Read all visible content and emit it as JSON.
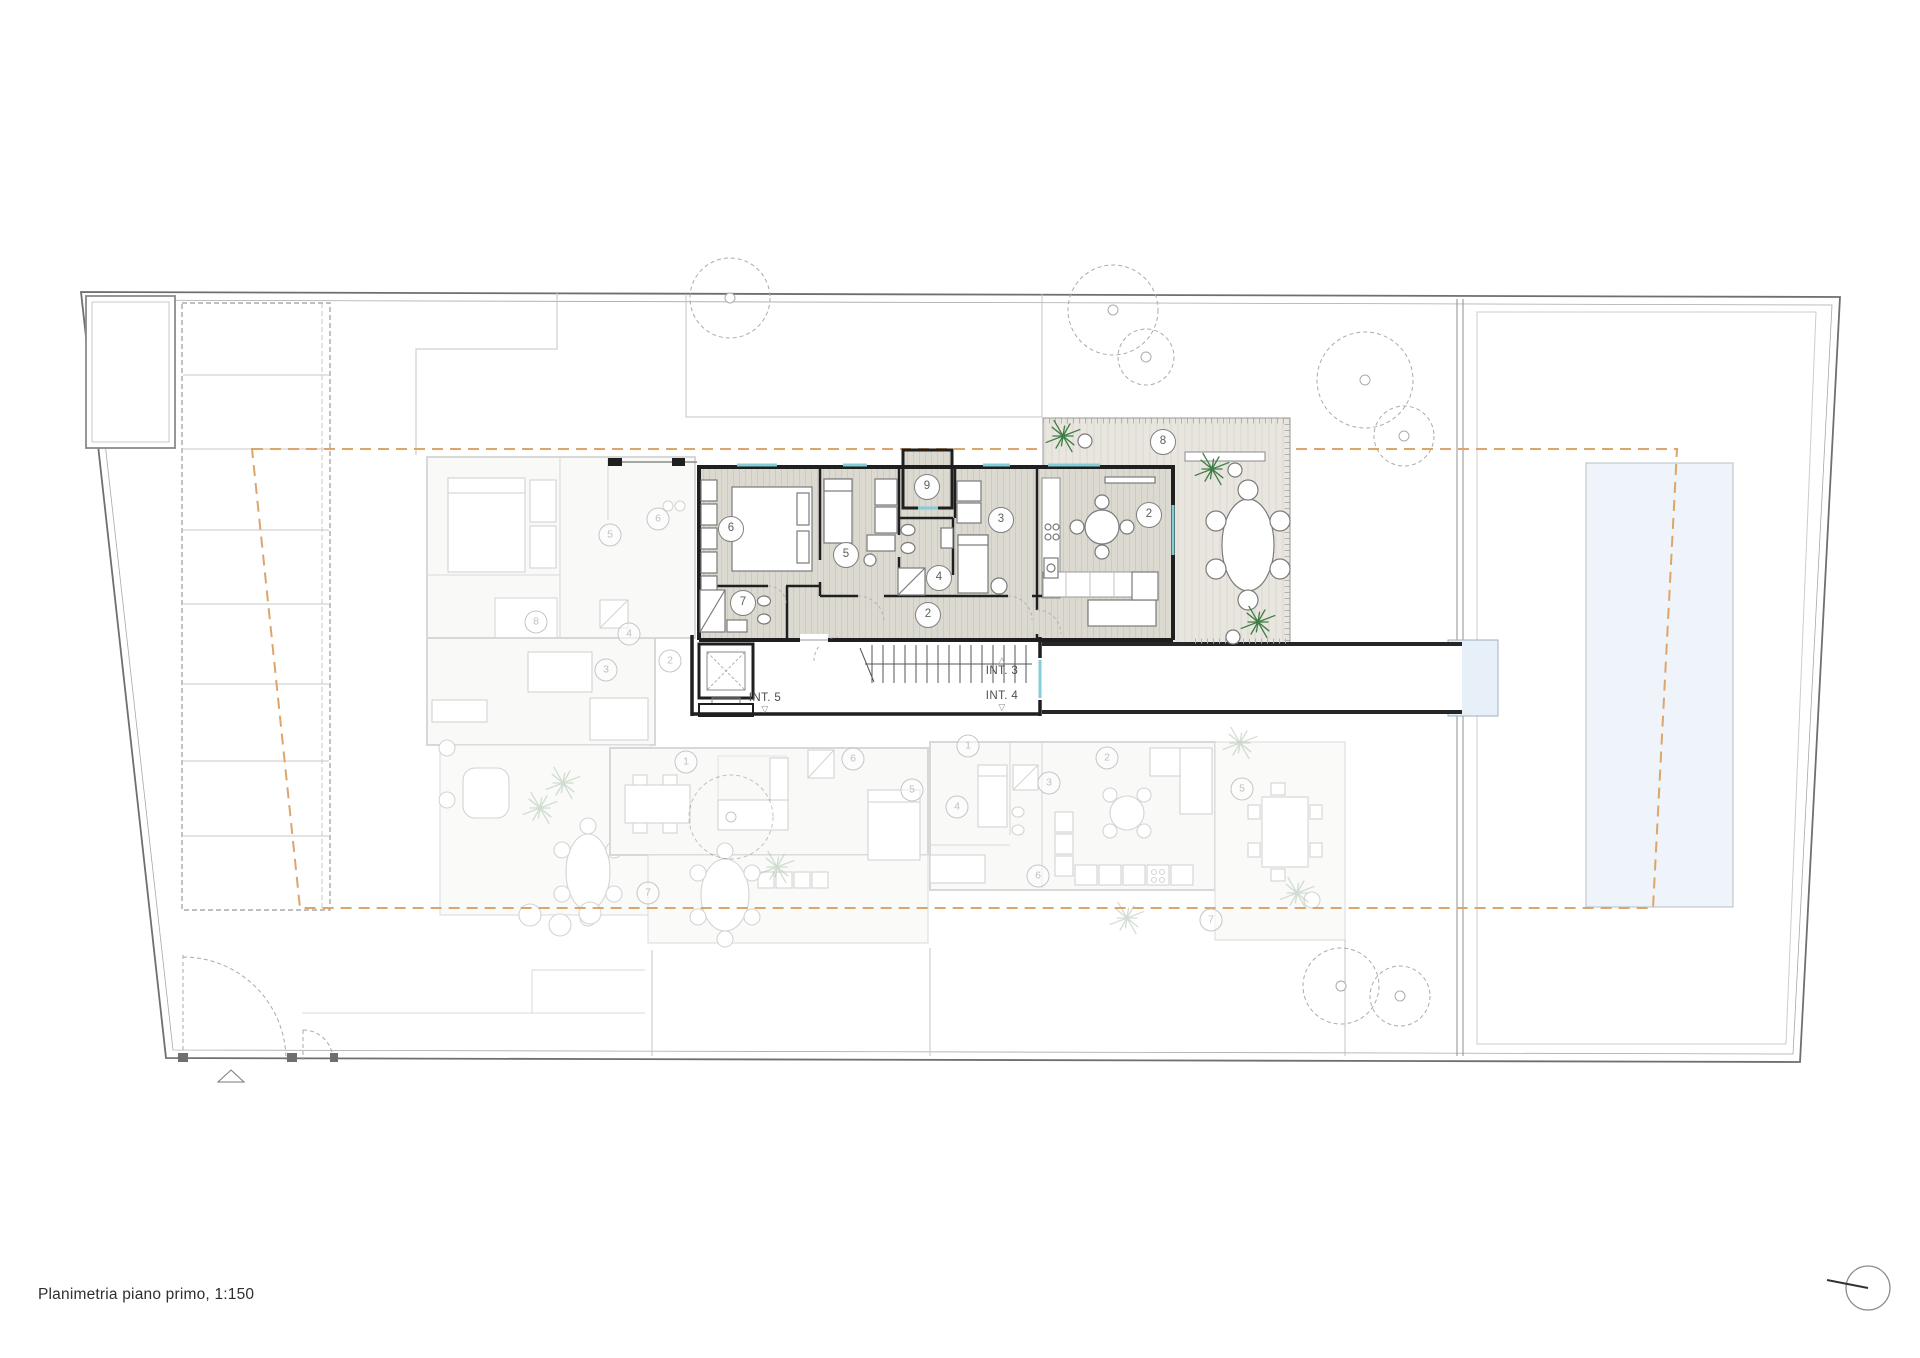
{
  "title": {
    "text": "Planimetria piano primo, 1:150"
  },
  "plan": {
    "floor_name": "piano primo",
    "scale": "1:150",
    "interior_labels": [
      {
        "id": "int3",
        "text": "INT. 3",
        "arrow_glyph": "△",
        "arrow_position": "above",
        "x": 1002,
        "y": 655
      },
      {
        "id": "int4",
        "text": "INT. 4",
        "arrow_glyph": "▽",
        "arrow_position": "below",
        "x": 1002,
        "y": 690
      },
      {
        "id": "int5",
        "text": "INT. 5",
        "arrow_glyph": "▽",
        "arrow_position": "below",
        "x": 765,
        "y": 692
      }
    ],
    "room_markers": {
      "active": [
        {
          "n": "6",
          "x": 731,
          "y": 529
        },
        {
          "n": "5",
          "x": 846,
          "y": 555
        },
        {
          "n": "9",
          "x": 927,
          "y": 487
        },
        {
          "n": "3",
          "x": 1001,
          "y": 520
        },
        {
          "n": "4",
          "x": 939,
          "y": 578
        },
        {
          "n": "7",
          "x": 743,
          "y": 603
        },
        {
          "n": "2",
          "x": 928,
          "y": 615
        },
        {
          "n": "2",
          "x": 1149,
          "y": 515
        },
        {
          "n": "8",
          "x": 1163,
          "y": 442
        }
      ],
      "faded": [
        {
          "n": "5",
          "x": 610,
          "y": 535
        },
        {
          "n": "6",
          "x": 658,
          "y": 519
        },
        {
          "n": "8",
          "x": 536,
          "y": 622
        },
        {
          "n": "4",
          "x": 629,
          "y": 634
        },
        {
          "n": "3",
          "x": 606,
          "y": 670
        },
        {
          "n": "2",
          "x": 670,
          "y": 661
        },
        {
          "n": "1",
          "x": 686,
          "y": 762
        },
        {
          "n": "6",
          "x": 853,
          "y": 759
        },
        {
          "n": "5",
          "x": 912,
          "y": 790
        },
        {
          "n": "7",
          "x": 648,
          "y": 893
        },
        {
          "n": "1",
          "x": 968,
          "y": 746
        },
        {
          "n": "2",
          "x": 1107,
          "y": 758
        },
        {
          "n": "3",
          "x": 1049,
          "y": 783
        },
        {
          "n": "4",
          "x": 957,
          "y": 807
        },
        {
          "n": "6",
          "x": 1038,
          "y": 876
        },
        {
          "n": "7",
          "x": 1211,
          "y": 920
        },
        {
          "n": "5",
          "x": 1242,
          "y": 789
        }
      ]
    },
    "trees": [
      {
        "x": 730,
        "y": 298,
        "r": 40
      },
      {
        "x": 1113,
        "y": 310,
        "r": 45
      },
      {
        "x": 1146,
        "y": 357,
        "r": 28
      },
      {
        "x": 1365,
        "y": 380,
        "r": 48
      },
      {
        "x": 1404,
        "y": 436,
        "r": 30
      },
      {
        "x": 731,
        "y": 817,
        "r": 42
      },
      {
        "x": 1341,
        "y": 986,
        "r": 38
      },
      {
        "x": 1400,
        "y": 996,
        "r": 30
      }
    ],
    "palms": {
      "active": [
        {
          "x": 1063,
          "y": 436
        },
        {
          "x": 1212,
          "y": 469
        },
        {
          "x": 1258,
          "y": 622
        }
      ],
      "faded": [
        {
          "x": 563,
          "y": 783
        },
        {
          "x": 540,
          "y": 808
        },
        {
          "x": 777,
          "y": 867
        },
        {
          "x": 1240,
          "y": 743
        },
        {
          "x": 1297,
          "y": 893
        },
        {
          "x": 1127,
          "y": 918
        }
      ]
    },
    "planters": [
      {
        "x": 1085,
        "y": 441
      },
      {
        "x": 1235,
        "y": 470
      },
      {
        "x": 1233,
        "y": 637
      }
    ],
    "colors": {
      "wall": "#1f1f1f",
      "setback_line": "#dda56b",
      "window": "#86ccd6",
      "pool_fill": "#eef4f9",
      "landing_fill": "#e7f0f8",
      "palm_green": "#3f7d46",
      "palm_faded": "#a9bfa9",
      "tree_outline": "#ababab"
    },
    "icons": [
      {
        "name": "north-indicator-icon"
      },
      {
        "name": "tree-canopy-icon"
      },
      {
        "name": "palm-plant-icon"
      },
      {
        "name": "direction-triangle-icon"
      }
    ]
  }
}
